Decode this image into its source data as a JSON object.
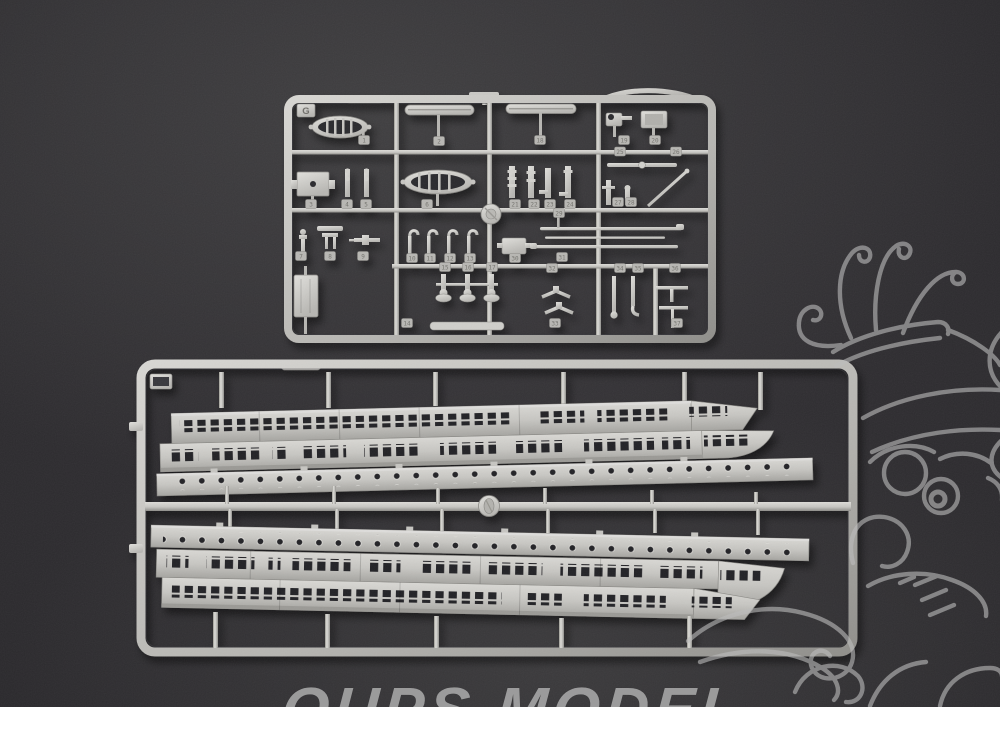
{
  "photo": {
    "caption": "Injection-molded plastic model kit sprues photographed on a dark charcoal background",
    "background_color": "#2a292b",
    "plastic_color": "#c6c5c3",
    "white_margin_color": "#ffffff"
  },
  "watermark": {
    "brand_text": "OUPS MODEL",
    "mascot": "cartoon-mascot-outline-drawing",
    "color": "#a9a9a9"
  },
  "sprues": {
    "top": {
      "label": "G",
      "description": "small-parts sprue with lifeboats, davits, ventilators, winches, spars and fittings",
      "part_numbers": [
        "1",
        "2",
        "18",
        "19",
        "20",
        "25",
        "26",
        "3",
        "4",
        "5",
        "6",
        "21",
        "22",
        "23",
        "24",
        "27",
        "28",
        "29",
        "7",
        "8",
        "9",
        "10",
        "11",
        "12",
        "13",
        "30",
        "31",
        "15",
        "16",
        "17",
        "32",
        "34",
        "35",
        "36",
        "14",
        "33",
        "37"
      ]
    },
    "bottom": {
      "label": "",
      "description": "large sprue holding two pairs of long ship superstructure side walls with rows of windows and porthole deck strips"
    }
  }
}
